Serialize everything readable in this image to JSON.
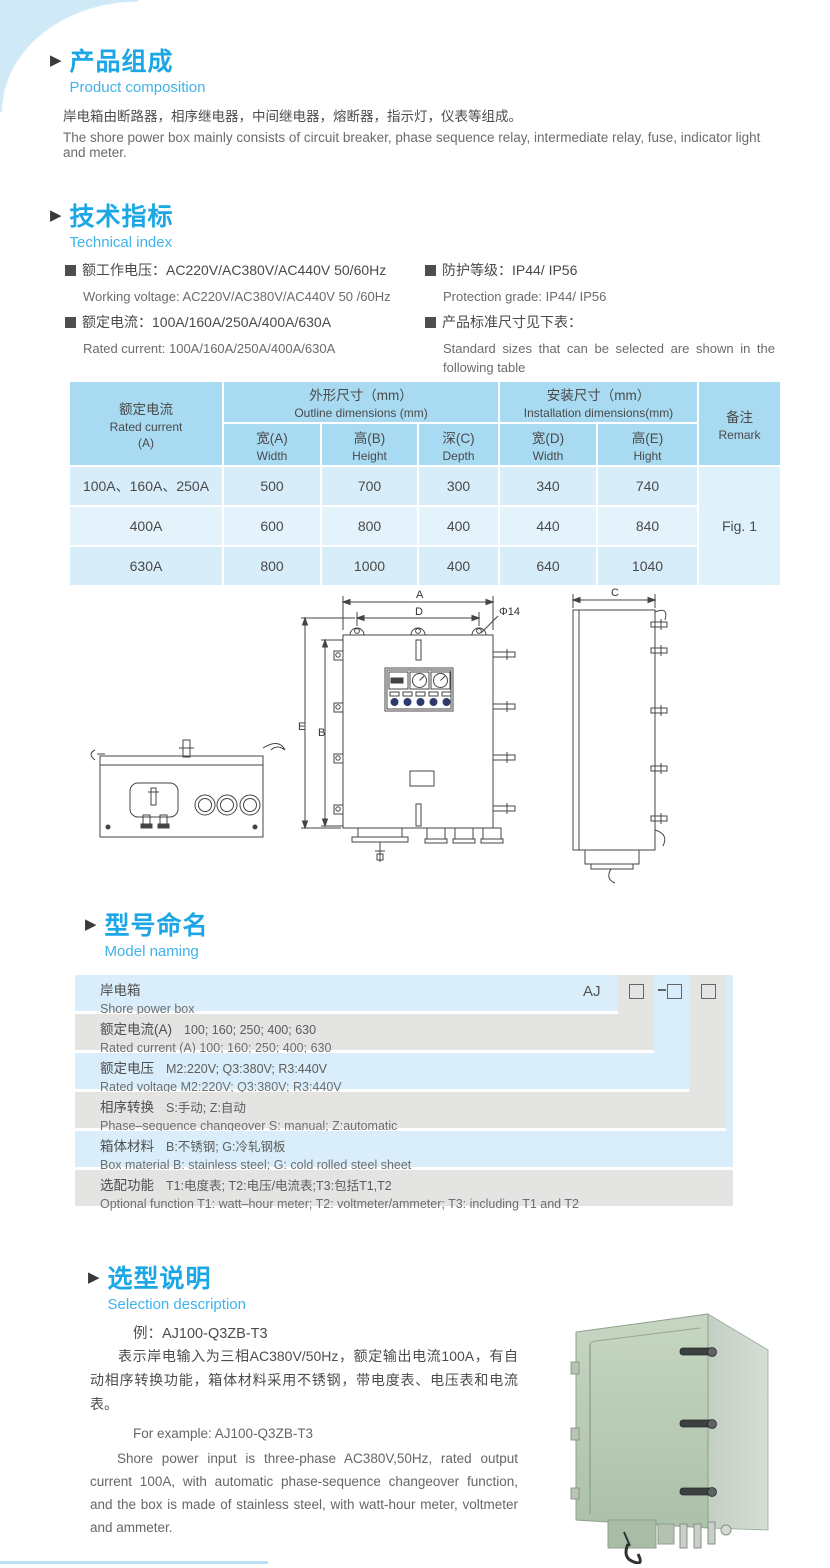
{
  "colors": {
    "accent_title": "#1ba7e5",
    "accent_sub": "#3fb3ea",
    "table_header": "#a8daf1",
    "table_row_a": "#d7edf9",
    "table_row_b": "#e4f3fb",
    "naming_blue": "#d9eefa",
    "naming_gray": "#e4e4e3",
    "corner_decor": "#cfe9f7",
    "photo_green": "#b7cbb4"
  },
  "composition": {
    "title_cn": "产品组成",
    "title_en": "Product  composition",
    "body_cn": "岸电箱由断路器，相序继电器，中间继电器，熔断器，指示灯，仪表等组成。",
    "body_en": "The shore power box mainly consists of circuit breaker, phase sequence relay, intermediate relay, fuse, indicator light and meter."
  },
  "technical": {
    "title_cn": "技术指标",
    "title_en": "Technical index",
    "items": [
      {
        "cn": "额工作电压：AC220V/AC380V/AC440V  50/60Hz",
        "en": "Working voltage: AC220V/AC380V/AC440V 50 /60Hz"
      },
      {
        "cn": "额定电流：100A/160A/250A/400A/630A",
        "en": "Rated current: 100A/160A/250A/400A/630A"
      },
      {
        "cn": "防护等级：IP44/ IP56",
        "en": "Protection grade: IP44/ IP56"
      },
      {
        "cn": "产品标准尺寸见下表：",
        "en": "Standard  sizes  that  can  be  selected  are  shown  in  the following table"
      }
    ]
  },
  "dimension_table": {
    "header": {
      "rated_cn": "额定电流",
      "rated_en": "Rated current",
      "rated_unit": "(A)",
      "outline_cn": "外形尺寸（mm）",
      "outline_en": "Outline dimensions (mm)",
      "install_cn": "安装尺寸（mm）",
      "install_en": "Installation dimensions(mm)",
      "remark_cn": "备注",
      "remark_en": "Remark",
      "cols": [
        {
          "cn": "宽(A)",
          "en": "Width"
        },
        {
          "cn": "高(B)",
          "en": "Height"
        },
        {
          "cn": "深(C)",
          "en": "Depth"
        },
        {
          "cn": "宽(D)",
          "en": "Width"
        },
        {
          "cn": "高(E)",
          "en": "Hight"
        }
      ]
    },
    "rows": [
      {
        "current": "100A、160A、250A",
        "values": [
          "500",
          "700",
          "300",
          "340",
          "740"
        ]
      },
      {
        "current": "400A",
        "values": [
          "600",
          "800",
          "400",
          "440",
          "840"
        ]
      },
      {
        "current": "630A",
        "values": [
          "800",
          "1000",
          "400",
          "640",
          "1040"
        ]
      }
    ],
    "remark": "Fig. 1"
  },
  "drawing": {
    "dim_a": "A",
    "dim_d": "D",
    "dim_e": "E",
    "dim_b": "B",
    "dim_c": "C",
    "hole": "Φ14"
  },
  "model_naming": {
    "title_cn": "型号命名",
    "title_en": "Model naming",
    "prefix": "AJ",
    "rows": [
      {
        "label_cn": "岸电箱",
        "detail_cn": "",
        "label_en": "Shore power box",
        "detail_en": ""
      },
      {
        "label_cn": "额定电流(A)",
        "detail_cn": "100; 160; 250; 400; 630",
        "label_en": "Rated current (A)",
        "detail_en": "100; 160; 250; 400; 630"
      },
      {
        "label_cn": "额定电压",
        "detail_cn": "M2:220V;  Q3:380V;  R3:440V",
        "label_en": "Rated voltage",
        "detail_en": "M2:220V;  Q3:380V;  R3:440V"
      },
      {
        "label_cn": "相序转换",
        "detail_cn": "S:手动; Z:自动",
        "label_en": "Phase–sequence changeover",
        "detail_en": "S: manual;  Z:automatic"
      },
      {
        "label_cn": "箱体材料",
        "detail_cn": "B:不锈钢;  G:冷轧钢板",
        "label_en": "Box material",
        "detail_en": "B: stainless steel; G: cold rolled steel sheet"
      },
      {
        "label_cn": "选配功能",
        "detail_cn": "T1:电度表;  T2:电压/电流表;T3:包括T1,T2",
        "label_en": "Optional function",
        "detail_en": "T1: watt–hour meter; T2: voltmeter/ammeter; T3: including T1 and T2"
      }
    ]
  },
  "selection": {
    "title_cn": "选型说明",
    "title_en": "Selection description",
    "example_cn": "例：AJ100-Q3ZB-T3",
    "body_cn": "表示岸电输入为三相AC380V/50Hz，额定输出电流100A，有自动相序转换功能，箱体材料采用不锈钢，带电度表、电压表和电流表。",
    "example_en": "For example: AJ100-Q3ZB-T3",
    "body_en": "Shore power input is three-phase AC380V,50Hz, rated output current 100A, with automatic phase-sequence changeover function, and the box is made of stainless steel, with watt-hour meter, voltmeter and ammeter."
  }
}
